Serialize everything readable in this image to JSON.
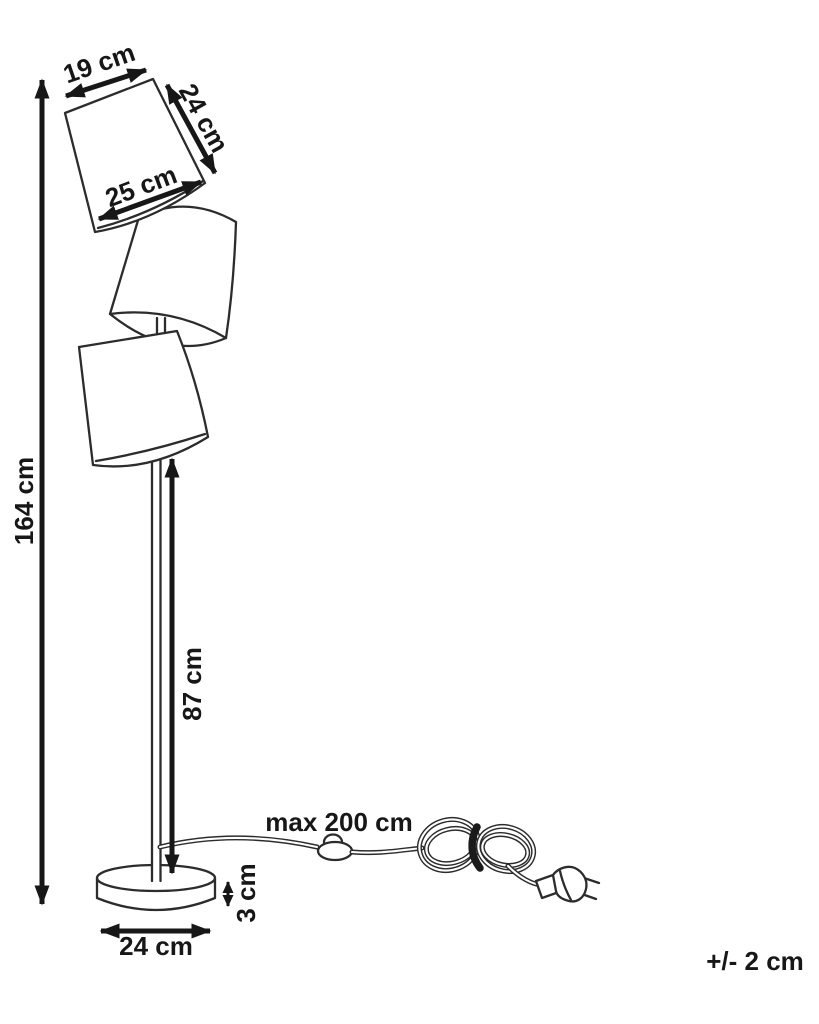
{
  "diagram": {
    "labels": {
      "shade_top_width": "19 cm",
      "shade_height": "24 cm",
      "shade_bottom_width": "25 cm",
      "total_height": "164 cm",
      "pole_height": "87 cm",
      "cable_length": "max 200 cm",
      "base_height": "3 cm",
      "base_diameter": "24 cm",
      "tolerance": "+/- 2 cm"
    },
    "colors": {
      "line": "#2c2c2c",
      "text": "#171717",
      "background": "#ffffff"
    }
  }
}
